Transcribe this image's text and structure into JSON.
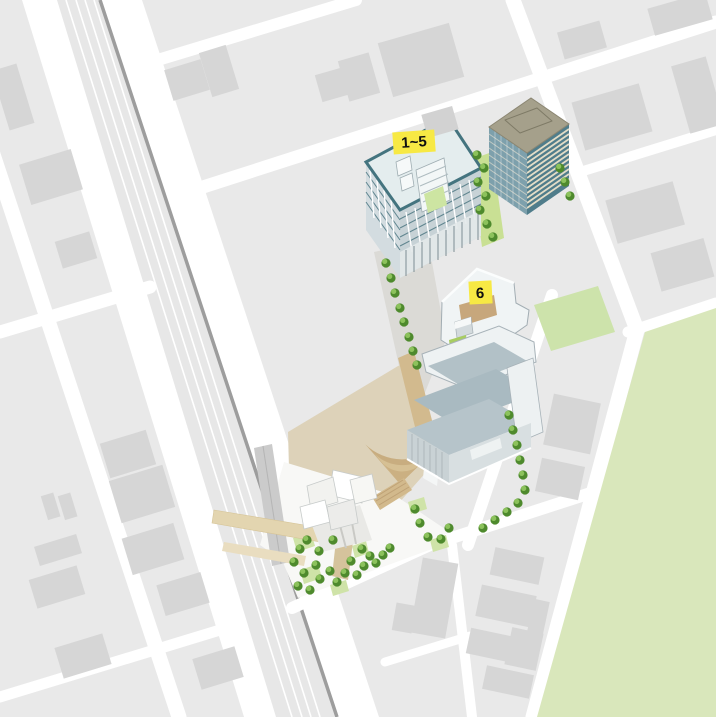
{
  "map": {
    "title": "campus-access-site-map",
    "markers": [
      {
        "id": "buildings-1-5",
        "label": "1~5"
      },
      {
        "id": "building-6",
        "label": "6"
      }
    ],
    "colors": {
      "street_white": "#ffffff",
      "block_gray": "#e9e9e9",
      "building_footprint_gray": "#d6d6d6",
      "railway_surface": "#e7e7e7",
      "railway_edge_dark": "#9d9d9d",
      "station_structure_gray": "#cbcbcb",
      "park_green": "#d9e7bb",
      "lawn_green": "#cde3ab",
      "tree_dark_green": "#4e8a2d",
      "tree_light_green": "#8cc25c",
      "plaza_beige": "#ddd2b9",
      "path_tan": "#d2ba8e",
      "amphitheater_tan": "#c8ad80",
      "bridge_beige": "#e3d5b0",
      "marker_yellow": "#f7e944",
      "building15_roof": "#e4edee",
      "building15_outline_teal": "#44747f",
      "complex_roof_blue_gray": "#a9bac1",
      "complex_white": "#f0f4f5",
      "tower_roof_tan": "#a5a08b",
      "tower_facade_teal": "#507d8b",
      "tower_floor_cream": "#e3ddc7",
      "terrace_tan": "#c7a77c",
      "roof_garden_green": "#a8cd61"
    }
  }
}
